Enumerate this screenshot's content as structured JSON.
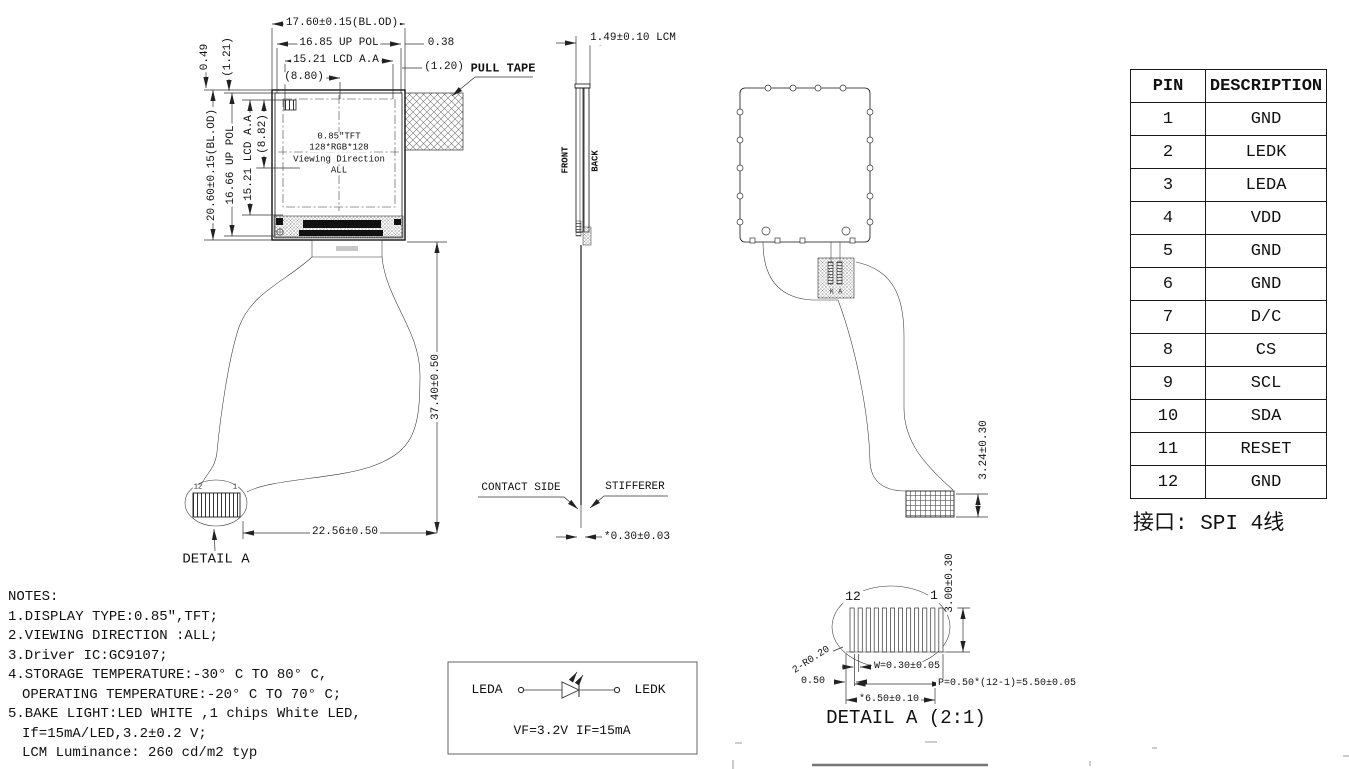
{
  "front_view": {
    "dims_top": {
      "overall": "17.60±0.15(BL.OD)",
      "pol": "16.85 UP POL",
      "active": "15.21 LCD A.A",
      "center": "(8.80)",
      "gap_right": "0.38",
      "gap_right2": "(1.20)"
    },
    "dims_left": {
      "overall": "20.60±0.15(BL.OD)",
      "pol": "16.66 UP POL",
      "active": "15.21 LCD A.A",
      "center": "(8.82)",
      "gap_top": "0.49",
      "gap_top2": "(1.21)"
    },
    "pull_tape_label": "PULL TAPE",
    "screen": {
      "line1": "0.85\"TFT",
      "line2": "128*RGB*128",
      "line3": "Viewing Direction",
      "line4": "ALL"
    },
    "dim_height": "37.40±0.50",
    "dim_width": "22.56±0.50",
    "detail_label": "DETAIL A",
    "connector_pin_left": "12",
    "connector_pin_right": "1"
  },
  "side_view": {
    "dim_thickness": "1.49±0.10 LCM",
    "front_label": "FRONT",
    "back_label": "BACK",
    "contact_label": "CONTACT SIDE",
    "stiffener_label": "STIFFERER",
    "dim_tip": "*0.30±0.03"
  },
  "back_view": {
    "dim_connector": "3.24±0.30",
    "led_pad_marks": "K A"
  },
  "pin_table": {
    "header": {
      "pin": "PIN",
      "description": "DESCRIPTION"
    },
    "rows": [
      {
        "pin": "1",
        "description": "GND"
      },
      {
        "pin": "2",
        "description": "LEDK"
      },
      {
        "pin": "3",
        "description": "LEDA"
      },
      {
        "pin": "4",
        "description": "VDD"
      },
      {
        "pin": "5",
        "description": "GND"
      },
      {
        "pin": "6",
        "description": "GND"
      },
      {
        "pin": "7",
        "description": "D/C"
      },
      {
        "pin": "8",
        "description": "CS"
      },
      {
        "pin": "9",
        "description": "SCL"
      },
      {
        "pin": "10",
        "description": "SDA"
      },
      {
        "pin": "11",
        "description": "RESET"
      },
      {
        "pin": "12",
        "description": "GND"
      }
    ],
    "interface_note": "接口: SPI 4线"
  },
  "notes": {
    "lines": [
      "NOTES:",
      "1.DISPLAY TYPE:0.85″,TFT;",
      "2.VIEWING DIRECTION :ALL;",
      "3.Driver IC:GC9107;",
      "4.STORAGE TEMPERATURE:-30° C TO 80° C,",
      "OPERATING TEMPERATURE:-20° C TO 70° C;",
      "5.BAKE LIGHT:LED WHITE ,1 chips White LED,",
      "If=15mA/LED,3.2±0.2 V;",
      "LCM Luminance: 260 cd/m2 typ"
    ]
  },
  "led_circuit": {
    "anode_label": "LEDA",
    "cathode_label": "LEDK",
    "spec": "VF=3.2V  IF=15mA"
  },
  "detail_a": {
    "title": "DETAIL A (2:1)",
    "pin_left": "12",
    "pin_right": "1",
    "dim_height": "3.00±0.30",
    "dim_radius": "2-R0.20",
    "dim_pin_width": "W=0.30±0.05",
    "dim_edge": "0.50",
    "dim_pitch": "P=0.50*(12-1)=5.50±0.05",
    "dim_total": "*6.50±0.10"
  }
}
